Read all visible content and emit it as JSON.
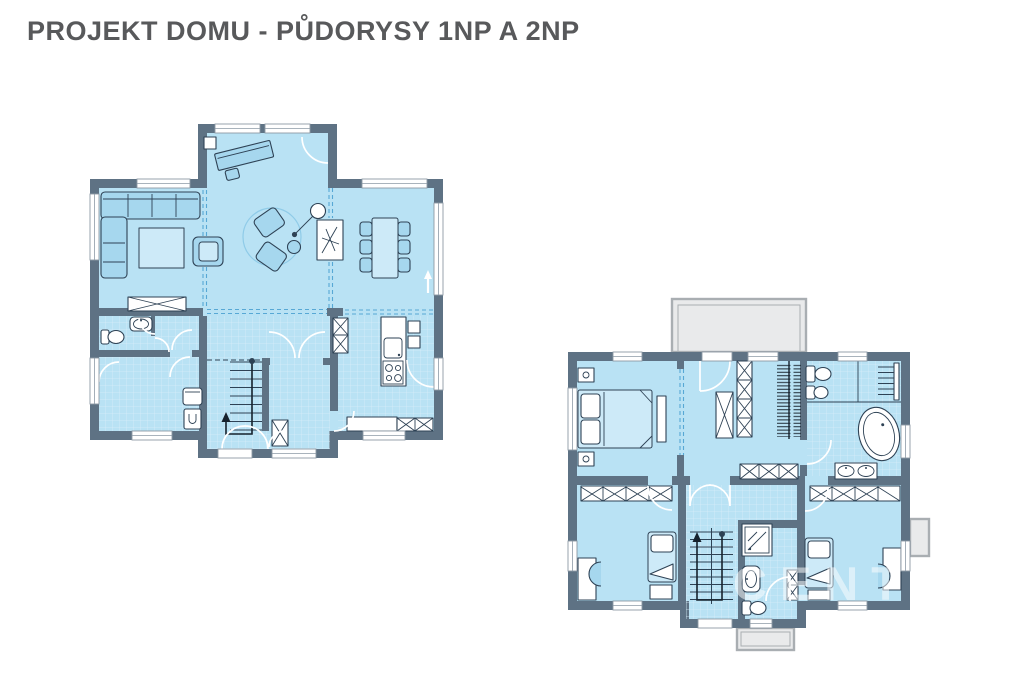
{
  "page": {
    "title": "PROJEKT DOMU - PŮDORYSY 1NP A 2NP"
  },
  "watermark": {
    "text": "CENTURY 2"
  },
  "colors": {
    "wall": "#5e7284",
    "floor": "#b9e2f4",
    "tileline": "#d7eef9",
    "furn": "#a6d7ee",
    "furnLight": "#cdeaf8",
    "line": "#2e4255",
    "dash": "#57a8d5",
    "winline": "#8d9aa6",
    "balcony": "#e9eaeb",
    "balconyBorder": "#a9aeb2",
    "title": "#58595b",
    "watermark": "#ffffff"
  }
}
